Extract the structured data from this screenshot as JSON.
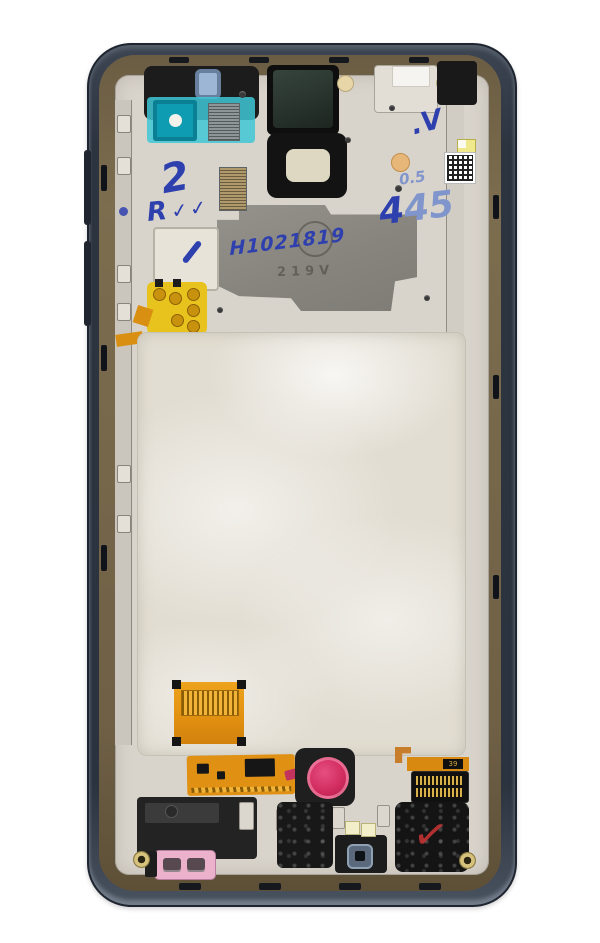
{
  "scene": {
    "type": "product-photo",
    "subject": "Smartphone display assembly frame, inner (rear) side, service replacement part",
    "background": "#ffffff"
  },
  "markings": {
    "serial_handwritten": "H1021819",
    "stamp_line": "219V",
    "mark_2": "2",
    "mark_r": "R",
    "mark_checks": "✓✓",
    "mark_dot_v": ".V",
    "mark_05": "0.5",
    "mark_445_dark": "4",
    "mark_445_light": "45",
    "connector_label": "39",
    "speaker_check": "✓"
  },
  "colors": {
    "rim": "#2c3440",
    "bezel_bronze": "#7a6a4d",
    "frame_body": "#d9d4cb",
    "magnesium_plate": "#8d8a84",
    "back_plate": "#e2ddd2",
    "teal_film": "#3ec7d6",
    "flex_orange": "#e59413",
    "flex_yellow": "#e8c21d",
    "sim_tray_pink": "#ecb2cb",
    "sensor_crimson": "#d12b5e",
    "ink_blue": "#2e3fae",
    "ink_light_blue": "#8095cc",
    "check_red": "#c23333"
  }
}
